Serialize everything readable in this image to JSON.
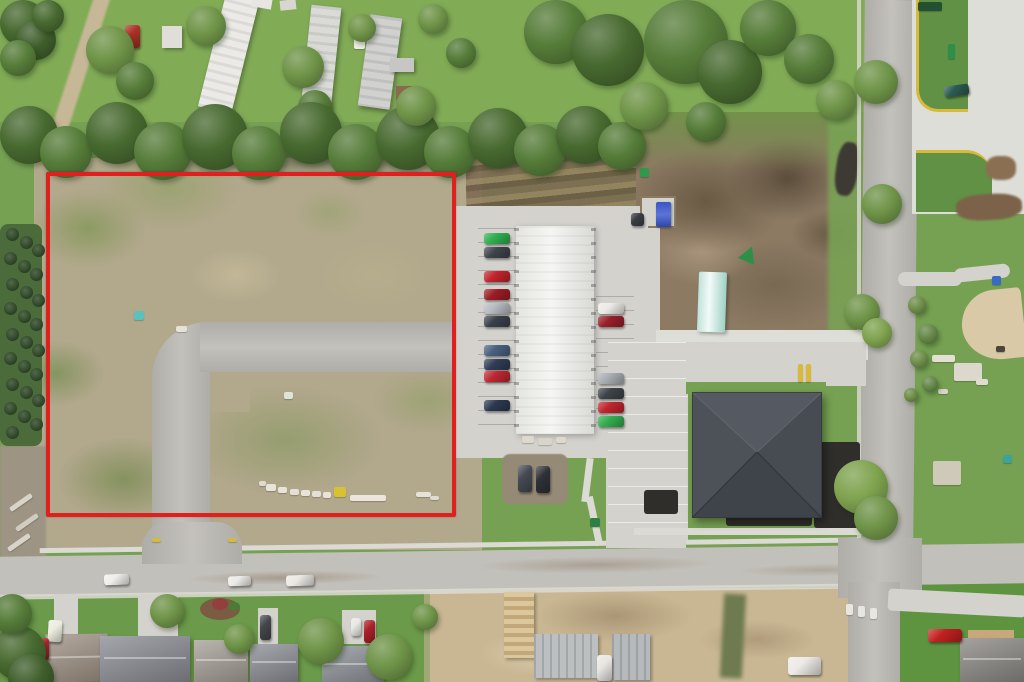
{
  "scene": {
    "type": "aerial-drone-photo",
    "subject": "vacant land parcel outlined in red beside a storage building with parked cars, an apartment building, streets and houses",
    "has_text": false
  },
  "boundary": {
    "color": "#e0201e",
    "stroke_px": 4
  },
  "colors": {
    "boundary": "#e0201e",
    "grass": "#76a152",
    "grassLight": "#8ab05e",
    "grassDark": "#4e7a3a",
    "treeDark": "#47692f",
    "tree": "#567c39",
    "treeLight": "#6f9448",
    "scrub": "#b2a88c",
    "scrubGreen": "#8d9c68",
    "dirt": "#8c7a63",
    "dirtDark": "#64543f",
    "sand": "#c9b794",
    "road": "#bcbab4",
    "concrete": "#d4d2cc",
    "concreteBright": "#deded8",
    "street": "#c2c0ba",
    "blacktop": "#2f2e2b",
    "whiteRoof": "#f2f2ef",
    "darkRoof": "#4a4e55",
    "yellowCurb": "#d8b93c",
    "sidewalk": "#dcdad4"
  },
  "sprites": {
    "trees": [
      [
        0,
        0,
        46,
        "#47692f"
      ],
      [
        16,
        20,
        40,
        "#3f5e2b"
      ],
      [
        0,
        40,
        36,
        "#567c39"
      ],
      [
        32,
        0,
        32,
        "#47692f"
      ],
      [
        86,
        26,
        48,
        "#6f9448"
      ],
      [
        116,
        62,
        38,
        "#567c39"
      ],
      [
        186,
        6,
        40,
        "#6f9448"
      ],
      [
        282,
        46,
        42,
        "#6f9448"
      ],
      [
        298,
        90,
        34,
        "#567c39"
      ],
      [
        348,
        14,
        28,
        "#6f9448"
      ],
      [
        418,
        4,
        30,
        "#6f9448"
      ],
      [
        446,
        38,
        30,
        "#567c39"
      ],
      [
        0,
        106,
        58,
        "#47692f"
      ],
      [
        40,
        126,
        52,
        "#567c39"
      ],
      [
        86,
        102,
        62,
        "#47692f"
      ],
      [
        134,
        122,
        58,
        "#567c39"
      ],
      [
        182,
        104,
        66,
        "#47692f"
      ],
      [
        232,
        126,
        54,
        "#567c39"
      ],
      [
        280,
        102,
        62,
        "#47692f"
      ],
      [
        328,
        124,
        56,
        "#567c39"
      ],
      [
        376,
        106,
        64,
        "#47692f"
      ],
      [
        424,
        126,
        52,
        "#567c39"
      ],
      [
        468,
        108,
        60,
        "#47692f"
      ],
      [
        514,
        124,
        52,
        "#567c39"
      ],
      [
        556,
        106,
        58,
        "#47692f"
      ],
      [
        598,
        122,
        48,
        "#567c39"
      ],
      [
        396,
        86,
        40,
        "#6f9448"
      ],
      [
        524,
        0,
        64,
        "#567c39"
      ],
      [
        572,
        14,
        72,
        "#47692f"
      ],
      [
        644,
        0,
        84,
        "#567c39"
      ],
      [
        698,
        40,
        64,
        "#47692f"
      ],
      [
        740,
        0,
        56,
        "#567c39"
      ],
      [
        784,
        34,
        50,
        "#567c39"
      ],
      [
        816,
        80,
        40,
        "#6f9448"
      ],
      [
        620,
        82,
        48,
        "#6f9448"
      ],
      [
        686,
        102,
        40,
        "#567c39"
      ],
      [
        854,
        60,
        44,
        "#6f9448"
      ],
      [
        862,
        184,
        40,
        "#6f9448"
      ],
      [
        844,
        294,
        36,
        "#6f9448"
      ],
      [
        862,
        318,
        30,
        "#7fa34f"
      ],
      [
        834,
        460,
        54,
        "#7fa34f"
      ],
      [
        854,
        496,
        44,
        "#6f9448"
      ],
      [
        908,
        296,
        18,
        "#6f8f4a"
      ],
      [
        918,
        324,
        20,
        "#66894a"
      ],
      [
        910,
        350,
        18,
        "#6f8f4a"
      ],
      [
        922,
        376,
        16,
        "#66894a"
      ],
      [
        904,
        388,
        14,
        "#6f8f4a"
      ],
      [
        -8,
        626,
        54,
        "#47692f"
      ],
      [
        8,
        654,
        46,
        "#3f5e2b"
      ],
      [
        -8,
        594,
        40,
        "#567c39"
      ],
      [
        150,
        594,
        34,
        "#6f9448"
      ],
      [
        224,
        624,
        30,
        "#6f9448"
      ],
      [
        298,
        618,
        46,
        "#6f9448"
      ],
      [
        366,
        634,
        46,
        "#6f9448"
      ],
      [
        412,
        604,
        26,
        "#6f9448"
      ]
    ],
    "evergreens": [
      [
        6,
        228
      ],
      [
        20,
        236
      ],
      [
        32,
        244
      ],
      [
        4,
        252
      ],
      [
        18,
        260
      ],
      [
        30,
        268
      ],
      [
        6,
        278
      ],
      [
        20,
        286
      ],
      [
        32,
        294
      ],
      [
        4,
        302
      ],
      [
        18,
        310
      ],
      [
        30,
        318
      ],
      [
        6,
        328
      ],
      [
        20,
        336
      ],
      [
        32,
        344
      ],
      [
        4,
        352
      ],
      [
        18,
        360
      ],
      [
        30,
        368
      ],
      [
        6,
        378
      ],
      [
        20,
        386
      ],
      [
        32,
        394
      ],
      [
        4,
        402
      ],
      [
        18,
        410
      ],
      [
        30,
        418
      ],
      [
        6,
        426
      ]
    ],
    "cars": [
      [
        484,
        233,
        26,
        11,
        "#2fae4f",
        0
      ],
      [
        484,
        247,
        26,
        11,
        "#3f434b",
        0
      ],
      [
        484,
        271,
        26,
        11,
        "#c2242c",
        0
      ],
      [
        484,
        289,
        26,
        11,
        "#9c1c25",
        0
      ],
      [
        484,
        303,
        26,
        11,
        "#b7babe",
        0
      ],
      [
        484,
        316,
        26,
        11,
        "#3a404b",
        0
      ],
      [
        484,
        345,
        26,
        11,
        "#49617e",
        0
      ],
      [
        484,
        359,
        26,
        11,
        "#303c55",
        0
      ],
      [
        484,
        371,
        26,
        11,
        "#bd2731",
        0
      ],
      [
        484,
        400,
        26,
        11,
        "#2c3850",
        0
      ],
      [
        598,
        303,
        26,
        11,
        "#eceae6",
        0
      ],
      [
        598,
        316,
        26,
        11,
        "#991f2a",
        0
      ],
      [
        598,
        373,
        26,
        11,
        "#a8adb2",
        0
      ],
      [
        598,
        388,
        26,
        11,
        "#3e4349",
        0
      ],
      [
        598,
        402,
        26,
        11,
        "#bf252d",
        0
      ],
      [
        598,
        416,
        26,
        11,
        "#32ad4d",
        0
      ],
      [
        104,
        574,
        25,
        11,
        "#efeeea",
        -2
      ],
      [
        228,
        576,
        23,
        10,
        "#eceae6",
        -2
      ],
      [
        286,
        575,
        28,
        11,
        "#e9e8e4",
        -2
      ],
      [
        125,
        25,
        15,
        23,
        "#ad3126",
        0
      ],
      [
        944,
        85,
        25,
        11,
        "#2c5a52",
        -8
      ],
      [
        631,
        213,
        13,
        13,
        "#3a3e42",
        0
      ],
      [
        518,
        465,
        14,
        27,
        "#454a52",
        0
      ],
      [
        536,
        466,
        14,
        27,
        "#2e3237",
        0
      ],
      [
        48,
        620,
        14,
        22,
        "#edecdf",
        3
      ],
      [
        39,
        638,
        10,
        22,
        "#ae2229",
        0
      ],
      [
        260,
        615,
        11,
        25,
        "#43474c",
        0
      ],
      [
        351,
        618,
        10,
        18,
        "#e9e8e4",
        0
      ],
      [
        364,
        620,
        11,
        23,
        "#a92027",
        0
      ],
      [
        928,
        629,
        34,
        13,
        "#c2201f",
        0
      ],
      [
        788,
        657,
        33,
        18,
        "#ebeae6",
        0
      ],
      [
        597,
        655,
        15,
        26,
        "#e7e6e2",
        0
      ]
    ],
    "debris": [
      [
        266,
        484,
        10,
        7,
        "#e8e4da",
        0
      ],
      [
        278,
        487,
        9,
        6,
        "#e8e4da",
        0
      ],
      [
        290,
        489,
        9,
        6,
        "#e4e0d6",
        0
      ],
      [
        301,
        490,
        9,
        6,
        "#e8e4da",
        0
      ],
      [
        312,
        491,
        9,
        6,
        "#e4e0d6",
        0
      ],
      [
        323,
        492,
        8,
        6,
        "#e8e4da",
        0
      ],
      [
        334,
        487,
        12,
        10,
        "#d8c133",
        0
      ],
      [
        350,
        495,
        36,
        6,
        "#eae6dc",
        0
      ],
      [
        259,
        481,
        7,
        5,
        "#e0dcd2",
        0
      ],
      [
        416,
        492,
        15,
        5,
        "#e6e2d8",
        0
      ],
      [
        430,
        496,
        9,
        4,
        "#e0dcd2",
        0
      ],
      [
        284,
        392,
        9,
        7,
        "#dfe4da",
        0
      ],
      [
        134,
        311,
        10,
        9,
        "#5cc0bc",
        0
      ],
      [
        176,
        326,
        11,
        6,
        "#e6e2d8",
        0
      ],
      [
        932,
        355,
        23,
        7,
        "#e4e0d6",
        0
      ],
      [
        954,
        363,
        28,
        18,
        "#dcd8ce",
        0
      ],
      [
        976,
        379,
        12,
        6,
        "#e0dcd2",
        0
      ],
      [
        938,
        389,
        10,
        5,
        "#d8d4ca",
        0
      ],
      [
        933,
        461,
        28,
        24,
        "#cfc9b9",
        0
      ],
      [
        1003,
        455,
        9,
        8,
        "#3aa49c",
        0
      ],
      [
        992,
        276,
        9,
        9,
        "#3a6ac8",
        0
      ],
      [
        640,
        168,
        9,
        9,
        "#2f9b4a",
        0
      ],
      [
        590,
        518,
        10,
        9,
        "#2e7f44",
        0
      ],
      [
        522,
        436,
        12,
        7,
        "#ddd9cf",
        0
      ],
      [
        538,
        438,
        14,
        7,
        "#d8d4ca",
        0
      ],
      [
        556,
        437,
        10,
        6,
        "#ddd9cf",
        0
      ],
      [
        846,
        604,
        7,
        11,
        "#e8e6e0",
        0
      ],
      [
        858,
        606,
        7,
        11,
        "#e8e6e0",
        0
      ],
      [
        870,
        608,
        7,
        11,
        "#e8e6e0",
        0
      ],
      [
        152,
        538,
        9,
        4,
        "#d6ba3e",
        0
      ],
      [
        228,
        538,
        9,
        4,
        "#d6ba3e",
        0
      ],
      [
        918,
        2,
        24,
        9,
        "#235031",
        0
      ],
      [
        948,
        44,
        7,
        15,
        "#2f8f4a",
        0
      ],
      [
        354,
        38,
        11,
        11,
        "#efeeea",
        0
      ],
      [
        8,
        500,
        26,
        5,
        "#d8d4c8",
        -35
      ],
      [
        14,
        520,
        26,
        5,
        "#d0ccc0",
        -35
      ],
      [
        6,
        540,
        26,
        5,
        "#d8d4c8",
        -35
      ],
      [
        996,
        346,
        9,
        6,
        "#4a443c",
        0
      ],
      [
        798,
        364,
        5,
        18,
        "#d8b93c",
        0
      ],
      [
        806,
        364,
        5,
        18,
        "#d8b93c",
        0
      ]
    ]
  }
}
